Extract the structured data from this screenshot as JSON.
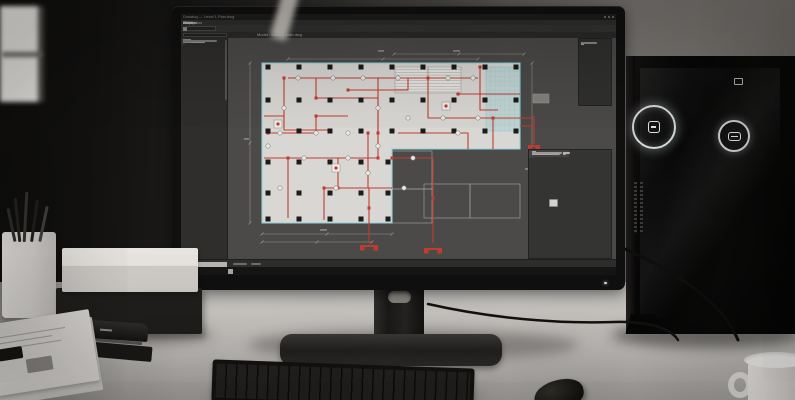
{
  "colors": {
    "accent_red": "#c23b30",
    "selection_cyan": "#8fd3dd",
    "plan_fill": "#d8d7d3",
    "canvas_bg": "#4b4a48"
  },
  "window": {
    "title": "Drawing — Level 1 Plan.dwg"
  },
  "menu": {
    "items": [
      "File",
      "Edit",
      "View",
      "Insert",
      "Format",
      "Tools",
      "Draw",
      "Dimension",
      "Modify",
      "Window",
      "Help"
    ]
  },
  "toolbar": {
    "icons": [
      "#b8b8b6",
      "#d2822e",
      "#e0e0de",
      "#8e8e8c",
      "#cfcfcd",
      "#9a9a98",
      "#d2822e",
      "#c4c4c2",
      "#8e8e8c",
      "#d8d8d6",
      "#a8a8a6",
      "#c9502e",
      "#d2822e",
      "#b8b8b6",
      "#d88a2e",
      "#c4c4c2",
      "#9a9a98",
      "#d2b02e",
      "#b0b0ae",
      "#8e8e8c"
    ]
  },
  "pathbar": {
    "text": "Model · Level-1-plan.dwg"
  },
  "left_palette": {
    "rows": [
      {
        "t": "header",
        "w": 22
      },
      {
        "t": "row",
        "i": "#b8b8b6",
        "w": 20
      },
      {
        "t": "row",
        "i": "#c0453a",
        "w": 26
      },
      {
        "t": "row",
        "i": "#b8b8b6",
        "w": 30,
        "ind": 1
      },
      {
        "t": "row",
        "i": "#c0453a",
        "w": 22,
        "ind": 1
      },
      {
        "t": "row",
        "i": "#8e8e8c",
        "w": 18
      },
      {
        "t": "gap"
      },
      {
        "t": "header",
        "w": 18
      },
      {
        "t": "row",
        "i": "#b8b8b6",
        "w": 24
      },
      {
        "t": "row",
        "i": "#b8b8b6",
        "w": 20,
        "ind": 1
      },
      {
        "t": "row",
        "i": "#e0e0de",
        "w": 16,
        "ind": 1
      },
      {
        "t": "row",
        "i": "#c0453a",
        "w": 27,
        "ind": 1
      },
      {
        "t": "row",
        "i": "#8e8e8c",
        "w": 22
      },
      {
        "t": "row",
        "i": "#c0453a",
        "w": 30
      },
      {
        "t": "row",
        "i": "#b8b8b6",
        "w": 25
      },
      {
        "t": "gap"
      },
      {
        "t": "header",
        "w": 20
      },
      {
        "t": "row",
        "i": "#b8b8b6",
        "w": 18
      },
      {
        "t": "row",
        "i": "#8e8e8c",
        "w": 24,
        "ind": 1
      },
      {
        "t": "row",
        "i": "#c0453a",
        "w": 21
      },
      {
        "t": "row",
        "i": "#d2822e",
        "w": 26
      },
      {
        "t": "row",
        "i": "#b8b8b6",
        "w": 16
      },
      {
        "t": "row",
        "i": "#8e8e8c",
        "w": 28
      },
      {
        "t": "row",
        "i": "#c0453a",
        "w": 19
      },
      {
        "t": "row",
        "i": "#b8b8b6",
        "w": 23
      },
      {
        "t": "row",
        "i": "#8e8e8c",
        "w": 17
      },
      {
        "t": "gap"
      },
      {
        "t": "row",
        "i": "#b8b8b6",
        "w": 21
      },
      {
        "t": "row",
        "i": "#c0453a",
        "w": 24
      },
      {
        "t": "row",
        "i": "#8e8e8c",
        "w": 19
      }
    ]
  },
  "upper_right_panel": {
    "rows": [
      14,
      12,
      16,
      10,
      13,
      11
    ]
  },
  "right_panel": {
    "rows": [
      {
        "t": "field",
        "l": 8,
        "v": 30,
        "bright": true
      },
      {
        "t": "field",
        "l": 8,
        "v": 26
      },
      {
        "t": "head",
        "w": 34
      },
      {
        "t": "field",
        "l": 10,
        "v": 34
      },
      {
        "t": "field",
        "l": 10,
        "v": 38
      },
      {
        "t": "field",
        "l": 10,
        "v": 24,
        "bright": true
      },
      {
        "t": "field",
        "l": 10,
        "v": 30
      },
      {
        "t": "head",
        "w": 20
      },
      {
        "t": "field",
        "l": 9,
        "v": 20
      },
      {
        "t": "field",
        "l": 9,
        "v": 22
      },
      {
        "t": "head",
        "w": 28
      }
    ],
    "list_icons": [
      {
        "c": "#c9c9c7",
        "w": 26
      },
      {
        "c": "#4b93c6",
        "w": 30
      },
      {
        "c": "#cf4a3c",
        "w": 24
      },
      {
        "c": "#d9d9d7",
        "w": 28
      },
      {
        "c": "#37a3a0",
        "w": 25
      },
      {
        "c": "#c9c9c7",
        "w": 22
      },
      {
        "c": "#5a9ad2",
        "w": 27
      },
      {
        "c": "#a9a9a7",
        "w": 20
      }
    ]
  },
  "taskbar": {
    "icons": [
      "#e8e8e8",
      "#d4503c",
      "#de8a3a",
      "#8a9aa8",
      "#e0e0e0",
      "#7ab4d8",
      "#d4605c",
      "#a8a8a8"
    ]
  },
  "plan": {
    "outline": "34,25 292,25 292,111 164,111 164,185 34,185",
    "column_size": 5,
    "columns": [
      [
        40,
        29
      ],
      [
        71,
        29
      ],
      [
        102,
        29
      ],
      [
        133,
        29
      ],
      [
        164,
        29
      ],
      [
        195,
        29
      ],
      [
        226,
        29
      ],
      [
        257,
        29
      ],
      [
        288,
        29
      ],
      [
        40,
        62
      ],
      [
        71,
        62
      ],
      [
        102,
        62
      ],
      [
        133,
        62
      ],
      [
        164,
        62
      ],
      [
        195,
        62
      ],
      [
        226,
        62
      ],
      [
        257,
        62
      ],
      [
        288,
        62
      ],
      [
        40,
        93
      ],
      [
        71,
        93
      ],
      [
        102,
        93
      ],
      [
        133,
        93
      ],
      [
        164,
        93
      ],
      [
        195,
        93
      ],
      [
        226,
        93
      ],
      [
        257,
        93
      ],
      [
        288,
        93
      ],
      [
        40,
        124
      ],
      [
        71,
        124
      ],
      [
        102,
        124
      ],
      [
        133,
        124
      ],
      [
        160,
        124
      ],
      [
        40,
        155
      ],
      [
        71,
        155
      ],
      [
        102,
        155
      ],
      [
        133,
        155
      ],
      [
        160,
        155
      ],
      [
        40,
        181
      ],
      [
        71,
        181
      ],
      [
        102,
        181
      ],
      [
        133,
        181
      ],
      [
        160,
        181
      ]
    ],
    "stair": {
      "x": 167,
      "y": 29,
      "w": 66,
      "h": 26
    },
    "cyan_region": {
      "x": 258,
      "y": 29,
      "w": 34,
      "h": 64
    },
    "rooms": [
      [
        164,
        113,
        40,
        38
      ],
      [
        164,
        151,
        40,
        34
      ],
      [
        196,
        146,
        46,
        34
      ],
      [
        242,
        146,
        50,
        34
      ]
    ],
    "pipes": [
      "M40,95 H88 V78 H120",
      "M56,40 V92 H100",
      "M88,40 V60 H150 V95",
      "M120,52 H180 V40",
      "M60,40 H250",
      "M150,40 V120 H110 V150",
      "M200,40 V80 H292",
      "M230,56 H292",
      "M252,29 V72 H270",
      "M36,120 H150",
      "M60,120 V180",
      "M96,150 H164",
      "M96,150 V182",
      "M140,95 V150",
      "M164,120 H205 V205",
      "M141,150 V205",
      "M170,95 H240 V111",
      "M265,80 V111",
      "M36,78 H56",
      "M292,80 H306",
      "M292,88 H306",
      "M306,78 V106"
    ],
    "junctions": [
      [
        40,
        95
      ],
      [
        88,
        78
      ],
      [
        56,
        40
      ],
      [
        88,
        60
      ],
      [
        150,
        95
      ],
      [
        120,
        52
      ],
      [
        200,
        40
      ],
      [
        150,
        120
      ],
      [
        110,
        150
      ],
      [
        60,
        120
      ],
      [
        96,
        150
      ],
      [
        140,
        95
      ],
      [
        164,
        120
      ],
      [
        230,
        56
      ],
      [
        252,
        29
      ],
      [
        265,
        80
      ],
      [
        205,
        160
      ],
      [
        141,
        170
      ]
    ],
    "devices": [
      [
        70,
        40
      ],
      [
        105,
        40
      ],
      [
        135,
        40
      ],
      [
        170,
        40
      ],
      [
        220,
        40
      ],
      [
        245,
        40
      ],
      [
        88,
        95
      ],
      [
        120,
        95
      ],
      [
        56,
        70
      ],
      [
        40,
        108
      ],
      [
        76,
        120
      ],
      [
        120,
        120
      ],
      [
        150,
        70
      ],
      [
        150,
        108
      ],
      [
        180,
        80
      ],
      [
        215,
        80
      ],
      [
        250,
        80
      ],
      [
        230,
        95
      ],
      [
        108,
        150
      ],
      [
        140,
        135
      ],
      [
        52,
        150
      ],
      [
        52,
        95
      ],
      [
        185,
        120
      ],
      [
        176,
        150
      ]
    ],
    "panels": [
      [
        50,
        86
      ],
      [
        108,
        130
      ],
      [
        218,
        68
      ]
    ],
    "risers": [
      [
        141,
        208
      ],
      [
        205,
        211
      ],
      [
        306,
        108
      ]
    ],
    "dims": [
      [
        166,
        16,
        296,
        16
      ],
      [
        60,
        21,
        250,
        21
      ],
      [
        22,
        25,
        22,
        185
      ],
      [
        304,
        25,
        304,
        208
      ],
      [
        34,
        196,
        164,
        196
      ],
      [
        34,
        204,
        144,
        204
      ]
    ],
    "dim_blobs": [
      [
        225,
        12,
        7
      ],
      [
        150,
        12,
        6
      ],
      [
        16,
        100,
        5
      ],
      [
        297,
        130,
        6
      ],
      [
        92,
        191,
        7
      ]
    ],
    "chip": [
      305,
      56,
      16,
      9
    ]
  }
}
